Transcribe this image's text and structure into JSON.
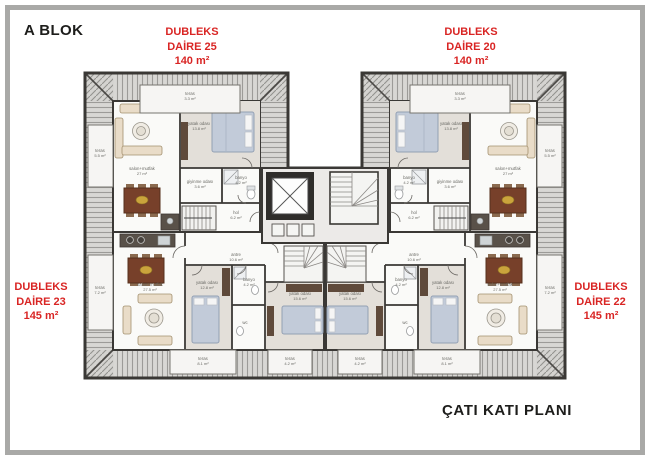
{
  "page": {
    "block_title": "A BLOK",
    "plan_title": "ÇATI KATI PLANI"
  },
  "apartments": {
    "top_left": {
      "type": "DUBLEKS",
      "unit": "DAİRE 25",
      "area": "140 m²"
    },
    "top_right": {
      "type": "DUBLEKS",
      "unit": "DAİRE 20",
      "area": "140 m²"
    },
    "bottom_left": {
      "type": "DUBLEKS",
      "unit": "DAİRE 23",
      "area": "145 m²"
    },
    "bottom_right": {
      "type": "DUBLEKS",
      "unit": "DAİRE 22",
      "area": "145 m²"
    }
  },
  "colors": {
    "accent_red": "#d92524",
    "ink": "#1d1d1b",
    "wall": "#3a3835",
    "roof_fill": "#d8d7d4",
    "roof_line": "#9c9b98",
    "wood": "#5f4a3b",
    "bed": "#c2cbd9",
    "sofa": "#e9dcc8",
    "dining_table": "#77402a"
  },
  "room_labels": [
    {
      "t": "teras",
      "a": "3.3 m²",
      "x": 190,
      "y": 95
    },
    {
      "t": "teras",
      "a": "5.5 m²",
      "x": 100,
      "y": 152
    },
    {
      "t": "salon+mutfak",
      "a": "27 m²",
      "x": 142,
      "y": 170
    },
    {
      "t": "yatak odası",
      "a": "13.8 m²",
      "x": 199,
      "y": 125
    },
    {
      "t": "giyinme odası",
      "a": "3.6 m²",
      "x": 200,
      "y": 183
    },
    {
      "t": "banyo",
      "a": "4.2 m²",
      "x": 241,
      "y": 179
    },
    {
      "t": "hol",
      "a": "6.2 m²",
      "x": 236,
      "y": 214
    },
    {
      "t": "teras",
      "a": "3.3 m²",
      "x": 460,
      "y": 95
    },
    {
      "t": "teras",
      "a": "5.5 m²",
      "x": 550,
      "y": 152
    },
    {
      "t": "salon+mutfak",
      "a": "27 m²",
      "x": 508,
      "y": 170
    },
    {
      "t": "yatak odası",
      "a": "13.8 m²",
      "x": 451,
      "y": 125
    },
    {
      "t": "giyinme odası",
      "a": "3.6 m²",
      "x": 450,
      "y": 183
    },
    {
      "t": "banyo",
      "a": "4.2 m²",
      "x": 409,
      "y": 179
    },
    {
      "t": "hol",
      "a": "6.2 m²",
      "x": 414,
      "y": 214
    },
    {
      "t": "antre",
      "a": "10.6 m²",
      "x": 236,
      "y": 256
    },
    {
      "t": "salon+mutfak",
      "a": "27.5 m²",
      "x": 150,
      "y": 286
    },
    {
      "t": "yatak odası",
      "a": "12.8 m²",
      "x": 207,
      "y": 284
    },
    {
      "t": "banyo",
      "a": "4.2 m²",
      "x": 249,
      "y": 281
    },
    {
      "t": "wc",
      "a": "",
      "x": 245,
      "y": 324
    },
    {
      "t": "yatak odası",
      "a": "15.6 m²",
      "x": 300,
      "y": 295
    },
    {
      "t": "teras",
      "a": "7.2 m²",
      "x": 100,
      "y": 289
    },
    {
      "t": "teras",
      "a": "8.1 m²",
      "x": 203,
      "y": 360
    },
    {
      "t": "teras",
      "a": "4.2 m²",
      "x": 290,
      "y": 360
    },
    {
      "t": "antre",
      "a": "10.6 m²",
      "x": 414,
      "y": 256
    },
    {
      "t": "salon+mutfak",
      "a": "27.5 m²",
      "x": 500,
      "y": 286
    },
    {
      "t": "yatak odası",
      "a": "12.8 m²",
      "x": 443,
      "y": 284
    },
    {
      "t": "banyo",
      "a": "4.2 m²",
      "x": 401,
      "y": 281
    },
    {
      "t": "wc",
      "a": "",
      "x": 405,
      "y": 324
    },
    {
      "t": "yatak odası",
      "a": "15.6 m²",
      "x": 350,
      "y": 295
    },
    {
      "t": "teras",
      "a": "7.2 m²",
      "x": 550,
      "y": 289
    },
    {
      "t": "teras",
      "a": "8.1 m²",
      "x": 447,
      "y": 360
    },
    {
      "t": "teras",
      "a": "4.2 m²",
      "x": 360,
      "y": 360
    }
  ]
}
